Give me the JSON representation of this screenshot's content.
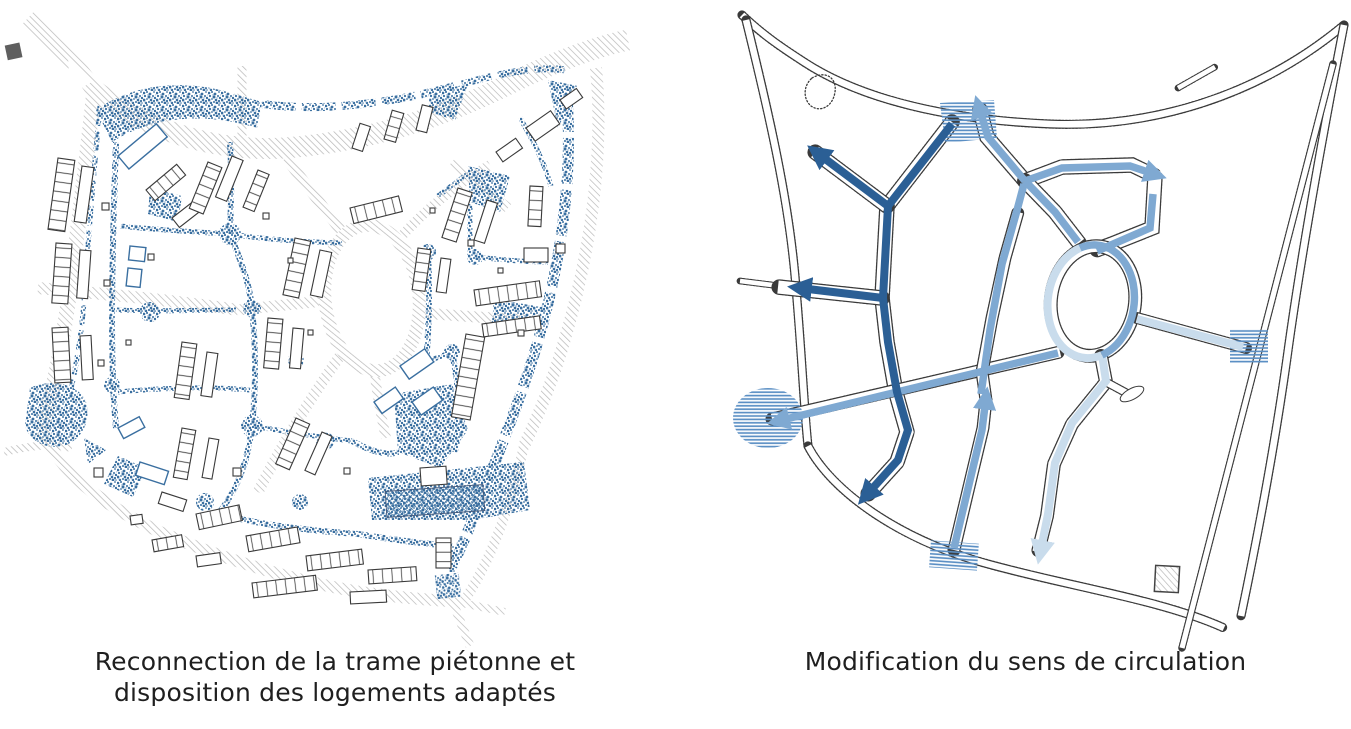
{
  "page": {
    "type": "urban-planning-figure",
    "background": "#ffffff"
  },
  "panels": {
    "left": {
      "id": "pedestrian-map",
      "caption_line1": "Reconnection de la trame piétonne et",
      "caption_line2": "disposition des logements adaptés"
    },
    "right": {
      "id": "circulation-map",
      "caption": "Modification du sens de circulation"
    }
  },
  "colors": {
    "caption-ink": "#1f1f1f",
    "road-hatch": "#bdbdbd",
    "pedestrian-blue": "#3a6fa0",
    "flow-strong": "#2b5f95",
    "flow-medium": "#7fa9d2",
    "flow-light": "#c9dcec",
    "crossing-stripe": "#5b8fc4",
    "map-outline": "#3a3a3a"
  }
}
